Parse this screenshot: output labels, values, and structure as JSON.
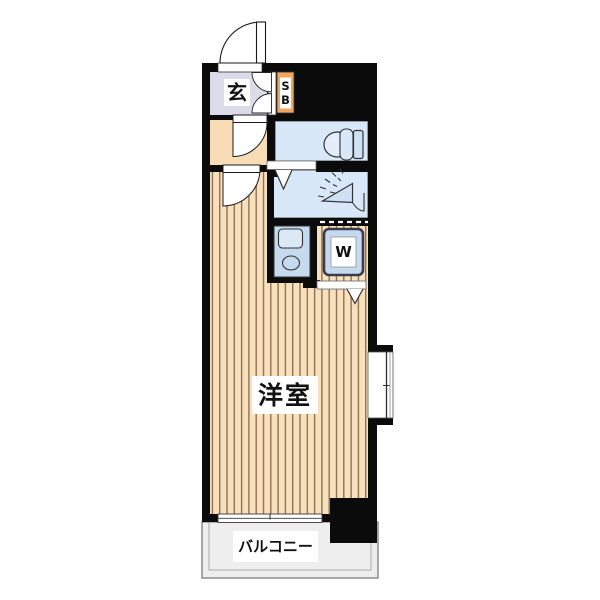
{
  "plan": {
    "type": "apartment-floor-plan",
    "labels": {
      "genkan": "玄",
      "shoebox_top": "S",
      "shoebox_bottom": "B",
      "washer": "W",
      "main_room": "洋室",
      "balcony": "バルコニー"
    },
    "rooms": [
      {
        "name": "entrance",
        "label": "玄"
      },
      {
        "name": "shoe-box",
        "label": "SB"
      },
      {
        "name": "toilet-room",
        "label": ""
      },
      {
        "name": "shower-room",
        "label": ""
      },
      {
        "name": "kitchen-counter",
        "label": ""
      },
      {
        "name": "washer-space",
        "label": "W"
      },
      {
        "name": "western-room",
        "label": "洋室"
      },
      {
        "name": "balcony",
        "label": "バルコニー"
      }
    ]
  },
  "colors": {
    "wall": "#0b0b0b",
    "genkan_floor": "#dcdbe9",
    "hallway_floor": "#f8dcb6",
    "flooring_base": "#f9e0bc",
    "flooring_stripe": "#8d7355",
    "wet_room_floor": "#d9e8f8",
    "counter": "#c5daef",
    "fixture_fill": "#cfe1f4",
    "shoebox_accent": "#f3a55e",
    "balcony_floor": "#eeeeee"
  }
}
